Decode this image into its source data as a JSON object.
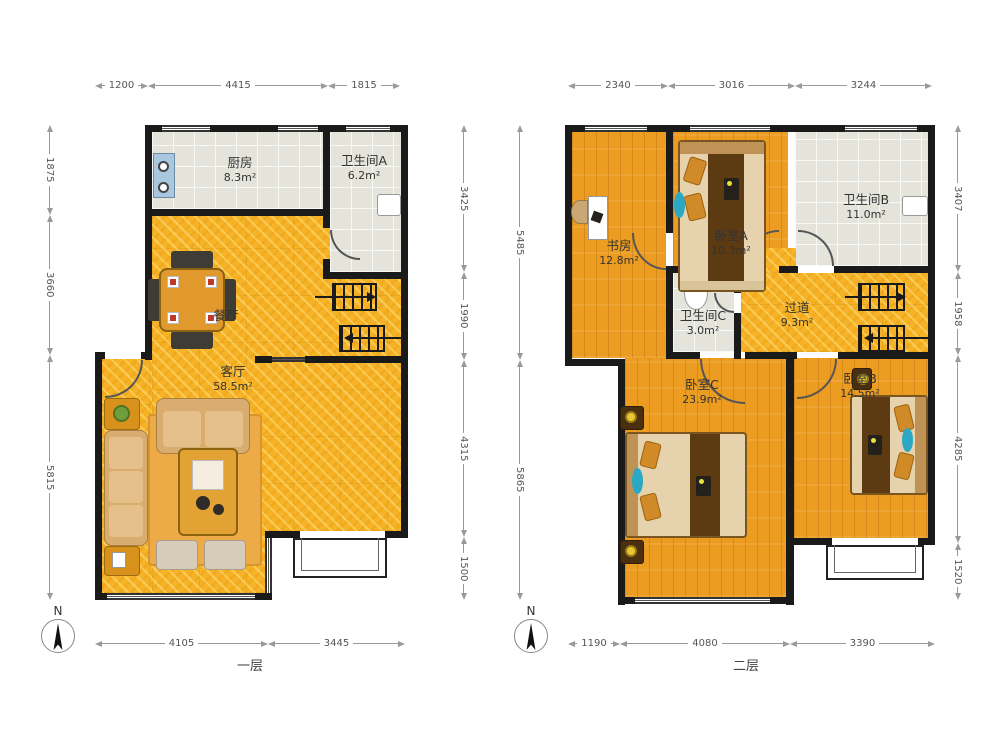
{
  "floors": {
    "first": {
      "label": "一层",
      "north": "N",
      "rooms": {
        "kitchen": {
          "name": "厨房",
          "area": "8.3m²"
        },
        "bathroom_a": {
          "name": "卫生间A",
          "area": "6.2m²"
        },
        "dining": {
          "name": "餐厅",
          "area": ""
        },
        "living": {
          "name": "客厅",
          "area": "58.5m²"
        }
      },
      "dims": {
        "top": [
          "1200",
          "4415",
          "1815"
        ],
        "left": [
          "1875",
          "3660",
          "5815"
        ],
        "right": [
          "3425",
          "1990",
          "4315",
          "1500"
        ],
        "bottom": [
          "4105",
          "3445"
        ]
      }
    },
    "second": {
      "label": "二层",
      "north": "N",
      "rooms": {
        "study": {
          "name": "书房",
          "area": "12.8m²"
        },
        "bedroom_a": {
          "name": "卧室A",
          "area": "10.3m²"
        },
        "bathroom_b": {
          "name": "卫生间B",
          "area": "11.0m²"
        },
        "bathroom_c": {
          "name": "卫生间C",
          "area": "3.0m²"
        },
        "hallway": {
          "name": "过道",
          "area": "9.3m²"
        },
        "bedroom_c": {
          "name": "卧室C",
          "area": "23.9m²"
        },
        "bedroom_b": {
          "name": "卧室B",
          "area": "14.5m²"
        }
      },
      "dims": {
        "top": [
          "2340",
          "3016",
          "3244"
        ],
        "left": [
          "5485",
          "5865"
        ],
        "right": [
          "3407",
          "1958",
          "4285",
          "1520"
        ],
        "bottom": [
          "1190",
          "4080",
          "3390"
        ]
      }
    }
  },
  "colors": {
    "wall": "#1a1a1a",
    "marble_floor": "#F7B327",
    "wood_floor": "#EC9C20",
    "tile_floor": "#E4E4DB",
    "accent_teal": "#2BA9C4"
  }
}
